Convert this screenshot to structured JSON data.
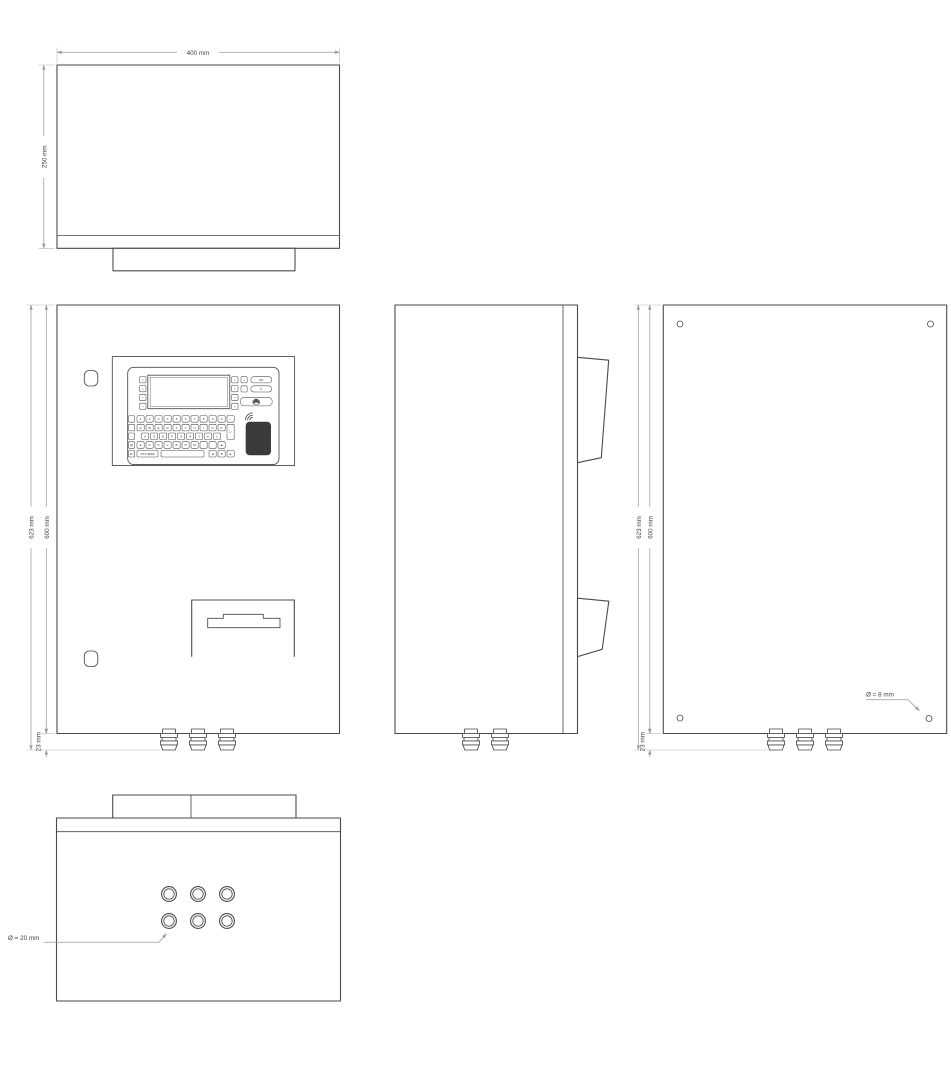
{
  "page": {
    "background": "#ffffff"
  },
  "colors": {
    "outline": "#4a4a4a",
    "dimension": "#9a9a9a",
    "extension": "#b8b8b8",
    "text": "#3f3f3f",
    "rfid_pad": "#3b3b3b"
  },
  "views": {
    "top": {
      "width_dim": "400 mm",
      "depth_dim": "250 mm"
    },
    "front": {
      "total_height_dim": "623 mm",
      "body_height_dim": "600 mm",
      "gland_height_dim": "23 mm"
    },
    "back": {
      "total_height_dim": "623 mm",
      "body_height_dim": "600 mm",
      "gland_height_dim": "23 mm",
      "mount_hole_note": "Ø = 8 mm"
    },
    "bottom": {
      "gland_hole_note": "Ø = 20 mm"
    }
  },
  "keypad": {
    "model_label": "STX-8080",
    "display_softkeys_left": [
      ">",
      ">",
      ">",
      ">"
    ],
    "display_softkeys_right": [
      "<",
      "<",
      "<",
      "<"
    ],
    "controls": {
      "plus": "+",
      "ok": "OK",
      "minus": "-",
      "cancel": "X"
    },
    "symbol_column": [
      ".",
      ",",
      "-",
      "@",
      "Fn"
    ],
    "row_digits": [
      "1",
      "2",
      "3",
      "4",
      "5",
      "6",
      "7",
      "8",
      "9",
      "0",
      "←"
    ],
    "row_qwerty": [
      "Q",
      "W",
      "E",
      "R",
      "T",
      "Y",
      "U",
      "I",
      "O",
      "P"
    ],
    "enter_key": "↵",
    "row_home": [
      "A",
      "S",
      "D",
      "F",
      "G",
      "H",
      "J",
      "K",
      "L"
    ],
    "row_lower": [
      "Z",
      "X",
      "C",
      "V",
      "B",
      "N",
      "M",
      ",",
      ".",
      "▲"
    ],
    "space_label": "",
    "arrow_keys": [
      "◄",
      "▼",
      "►"
    ]
  }
}
